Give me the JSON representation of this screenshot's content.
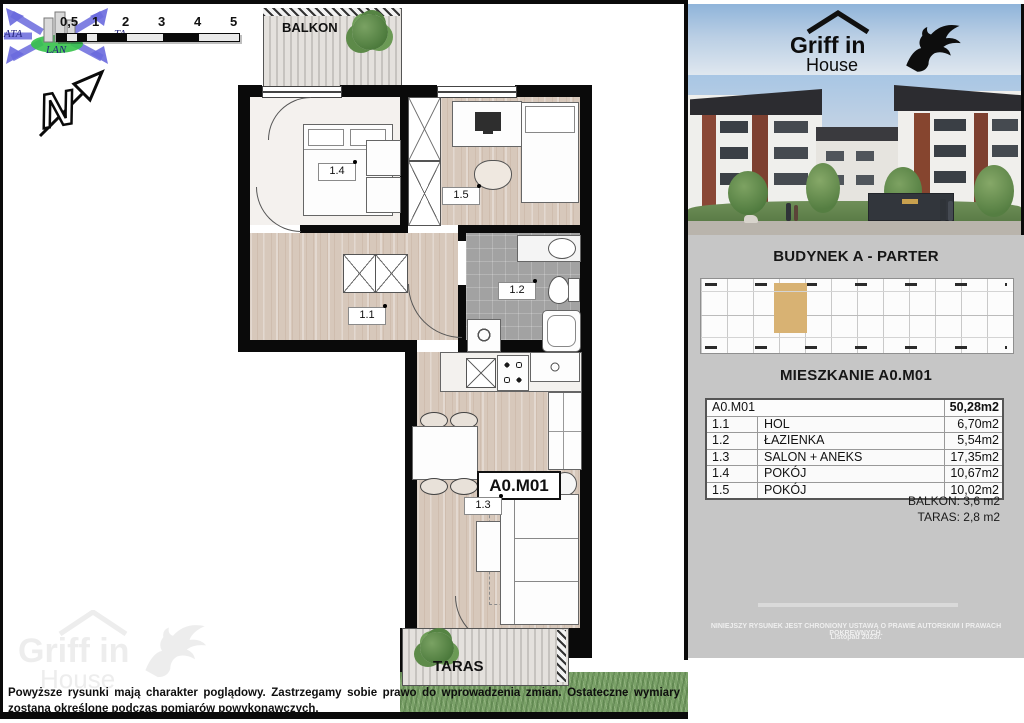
{
  "plan": {
    "balcony_label": "BALKON",
    "terrace_label": "TARAS",
    "unit_label": "A0.M01",
    "room_labels": [
      "1.1",
      "1.2",
      "1.3",
      "1.4",
      "1.5"
    ],
    "scale_labels": [
      "0,5",
      "1",
      "2",
      "3",
      "4",
      "5"
    ],
    "north_letter": "N"
  },
  "watermark": {
    "t1": "ATA",
    "t2": "TA",
    "t3": "LAN"
  },
  "brand": {
    "line1": "Griff in",
    "line2": "House"
  },
  "footer": {
    "disclaimer": "Powyższe rysunki mają charakter poglądowy.  Zastrzegamy sobie prawo do wprowadzenia zmian. Ostateczne wymiary zostaną określone podczas pomiarów powykonawczych."
  },
  "sidebar": {
    "building_title": "BUDYNEK A - PARTER",
    "apartment_title": "MIESZKANIE A0.M01",
    "table": {
      "unit": "A0.M01",
      "total": "50,28m2",
      "rows": [
        {
          "no": "1.1",
          "name": "HOL",
          "area": "6,70m2"
        },
        {
          "no": "1.2",
          "name": "ŁAZIENKA",
          "area": "5,54m2"
        },
        {
          "no": "1.3",
          "name": "SALON + ANEKS",
          "area": "17,35m2"
        },
        {
          "no": "1.4",
          "name": "POKÓJ",
          "area": "10,67m2"
        },
        {
          "no": "1.5",
          "name": "POKÓJ",
          "area": "10,02m2"
        }
      ],
      "balcony": "BALKON: 3,6 m2",
      "terrace": "TARAS: 2,8 m2"
    },
    "copyright1": "NINIEJSZY RYSUNEK JEST CHRONIONY USTAWĄ O PRAWIE AUTORSKIM I PRAWACH POKREWNYCH.",
    "copyright2": "Listopad 2023r."
  },
  "colors": {
    "highlight": "#d8b273",
    "panel": "#c6c6c6",
    "wall": "#0a0a0a",
    "grass": "#7aa168"
  }
}
